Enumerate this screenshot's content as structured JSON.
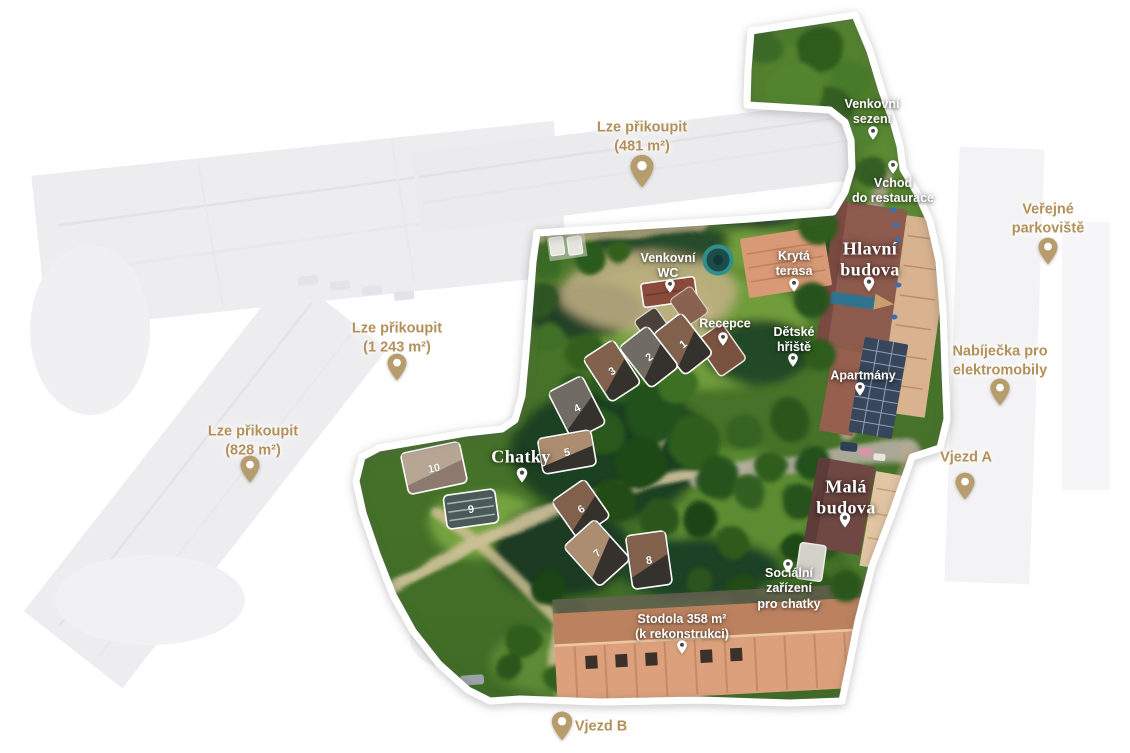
{
  "canvas": {
    "width": 1130,
    "height": 753
  },
  "colors": {
    "gold_text": "#b29059",
    "pin_gold": "#b79c6e",
    "pin_white": "#ffffff",
    "pin_hole_dark": "#4c4a45",
    "label_white": "#ffffff",
    "grass_light": "#6f9c3a",
    "grass_dark": "#3e6a26",
    "roof_main": "#8d5a4e",
    "roof_barn": "#dca17c"
  },
  "labels": [
    {
      "id": "lze-prikoupit-481",
      "style": "gold",
      "x": 642,
      "y": 137,
      "lines": [
        "Lze přikoupit",
        "(481 m²)"
      ],
      "pin": {
        "x": 642,
        "y": 171,
        "w": 27,
        "h": 35,
        "style": "gold"
      }
    },
    {
      "id": "lze-prikoupit-1243",
      "style": "gold",
      "x": 397,
      "y": 338,
      "lines": [
        "Lze přikoupit",
        "(1 243 m²)"
      ],
      "pin": {
        "x": 397,
        "y": 367,
        "w": 22,
        "h": 29,
        "style": "gold"
      }
    },
    {
      "id": "lze-prikoupit-828",
      "style": "gold",
      "x": 253,
      "y": 441,
      "lines": [
        "Lze přikoupit",
        "(828 m²)"
      ],
      "pin": {
        "x": 250,
        "y": 469,
        "w": 22,
        "h": 29,
        "style": "gold"
      }
    },
    {
      "id": "verejne-parkoviste",
      "style": "gold",
      "x": 1048,
      "y": 219,
      "lines": [
        "Veřejné",
        "parkoviště"
      ],
      "pin": {
        "x": 1048,
        "y": 251,
        "w": 22,
        "h": 29,
        "style": "gold"
      }
    },
    {
      "id": "nabijecka-pro-elektromobily",
      "style": "gold",
      "x": 1000,
      "y": 361,
      "lines": [
        "Nabíječka pro",
        "elektromobily"
      ],
      "pin": {
        "x": 1000,
        "y": 392,
        "w": 22,
        "h": 29,
        "style": "gold"
      }
    },
    {
      "id": "vjezd-a",
      "style": "gold",
      "x": 966,
      "y": 458,
      "lines": [
        "Vjezd A"
      ],
      "pin": {
        "x": 965,
        "y": 486,
        "w": 22,
        "h": 29,
        "style": "gold"
      }
    },
    {
      "id": "vjezd-b",
      "style": "gold",
      "x": 601,
      "y": 727,
      "lines": [
        "Vjezd B"
      ],
      "pin": {
        "x": 562,
        "y": 726,
        "w": 24,
        "h": 31,
        "style": "gold"
      }
    },
    {
      "id": "venkovni-sezeni",
      "style": "white",
      "x": 872,
      "y": 112,
      "lines": [
        "Venkovní",
        "sezení"
      ],
      "pin": {
        "x": 873,
        "y": 133,
        "w": 11,
        "h": 15,
        "style": "white"
      }
    },
    {
      "id": "vchod-do-restaurace",
      "style": "white",
      "x": 893,
      "y": 191,
      "lines": [
        "Vchod",
        "do restaurace"
      ],
      "pin": {
        "x": 893,
        "y": 167,
        "w": 11,
        "h": 15,
        "style": "white"
      }
    },
    {
      "id": "venkovni-wc",
      "style": "white",
      "x": 668,
      "y": 266,
      "lines": [
        "Venkovní",
        "WC"
      ],
      "pin": {
        "x": 670,
        "y": 286,
        "w": 11,
        "h": 15,
        "style": "white"
      }
    },
    {
      "id": "kryta-terasa",
      "style": "white",
      "x": 794,
      "y": 264,
      "lines": [
        "Krytá",
        "terasa"
      ],
      "pin": {
        "x": 794,
        "y": 285,
        "w": 11,
        "h": 15,
        "style": "white"
      }
    },
    {
      "id": "recepce",
      "style": "white",
      "x": 725,
      "y": 324,
      "lines": [
        "Recepce"
      ],
      "pin": {
        "x": 723,
        "y": 339,
        "w": 11,
        "h": 15,
        "style": "white"
      }
    },
    {
      "id": "detske-hriste",
      "style": "white",
      "x": 794,
      "y": 340,
      "lines": [
        "Dětské",
        "hřiště"
      ],
      "pin": {
        "x": 793,
        "y": 360,
        "w": 11,
        "h": 15,
        "style": "white"
      }
    },
    {
      "id": "apartmany",
      "style": "white",
      "x": 863,
      "y": 376,
      "lines": [
        "Apartmány"
      ],
      "pin": {
        "x": 860,
        "y": 389,
        "w": 11,
        "h": 15,
        "style": "white"
      }
    },
    {
      "id": "socialni-zarizeni-pro-chatky",
      "style": "white",
      "x": 789,
      "y": 589,
      "lines": [
        "Sociální",
        "zařízení",
        "pro chatky"
      ],
      "pin": {
        "x": 788,
        "y": 566,
        "w": 11,
        "h": 15,
        "style": "white"
      }
    },
    {
      "id": "stodola",
      "style": "white",
      "x": 682,
      "y": 627,
      "lines": [
        "Stodola 358 m²",
        "(k rekonstrukci)"
      ],
      "pin": {
        "x": 682,
        "y": 647,
        "w": 11,
        "h": 15,
        "style": "white"
      }
    },
    {
      "id": "hlavni-budova",
      "style": "serif",
      "x": 870,
      "y": 259,
      "lines": [
        "Hlavní",
        "budova"
      ],
      "pin": {
        "x": 869,
        "y": 284,
        "w": 12,
        "h": 16,
        "style": "white"
      }
    },
    {
      "id": "mala-budova",
      "style": "serif",
      "x": 846,
      "y": 497,
      "lines": [
        "Malá",
        "budova"
      ],
      "pin": {
        "x": 845,
        "y": 520,
        "w": 12,
        "h": 16,
        "style": "white"
      }
    },
    {
      "id": "chatky",
      "style": "serif",
      "x": 521,
      "y": 457,
      "lines": [
        "Chatky"
      ],
      "pin": {
        "x": 522,
        "y": 475,
        "w": 12,
        "h": 16,
        "style": "white"
      }
    }
  ],
  "cabins": {
    "number_color": "#ffffff",
    "items": [
      {
        "n": "1",
        "x": 683,
        "y": 344,
        "w": 36,
        "h": 52,
        "r": -38,
        "tone": "brown"
      },
      {
        "n": "2",
        "x": 649,
        "y": 357,
        "w": 36,
        "h": 52,
        "r": -38,
        "tone": "gray"
      },
      {
        "n": "3",
        "x": 612,
        "y": 371,
        "w": 36,
        "h": 52,
        "r": -33,
        "tone": "brown"
      },
      {
        "n": "4",
        "x": 577,
        "y": 408,
        "w": 38,
        "h": 54,
        "r": -27,
        "tone": "gray"
      },
      {
        "n": "5",
        "x": 567,
        "y": 452,
        "w": 54,
        "h": 36,
        "r": -10,
        "tone": "tan"
      },
      {
        "n": "6",
        "x": 581,
        "y": 509,
        "w": 40,
        "h": 46,
        "r": -35,
        "tone": "brown"
      },
      {
        "n": "7",
        "x": 597,
        "y": 553,
        "w": 42,
        "h": 54,
        "r": -42,
        "tone": "tan"
      },
      {
        "n": "8",
        "x": 649,
        "y": 560,
        "w": 40,
        "h": 54,
        "r": -8,
        "tone": "brown"
      },
      {
        "n": "9",
        "x": 471,
        "y": 509,
        "w": 52,
        "h": 34,
        "r": -8,
        "tone": "striped"
      },
      {
        "n": "10",
        "x": 434,
        "y": 468,
        "w": 60,
        "h": 42,
        "r": -12,
        "tone": "light"
      }
    ]
  }
}
